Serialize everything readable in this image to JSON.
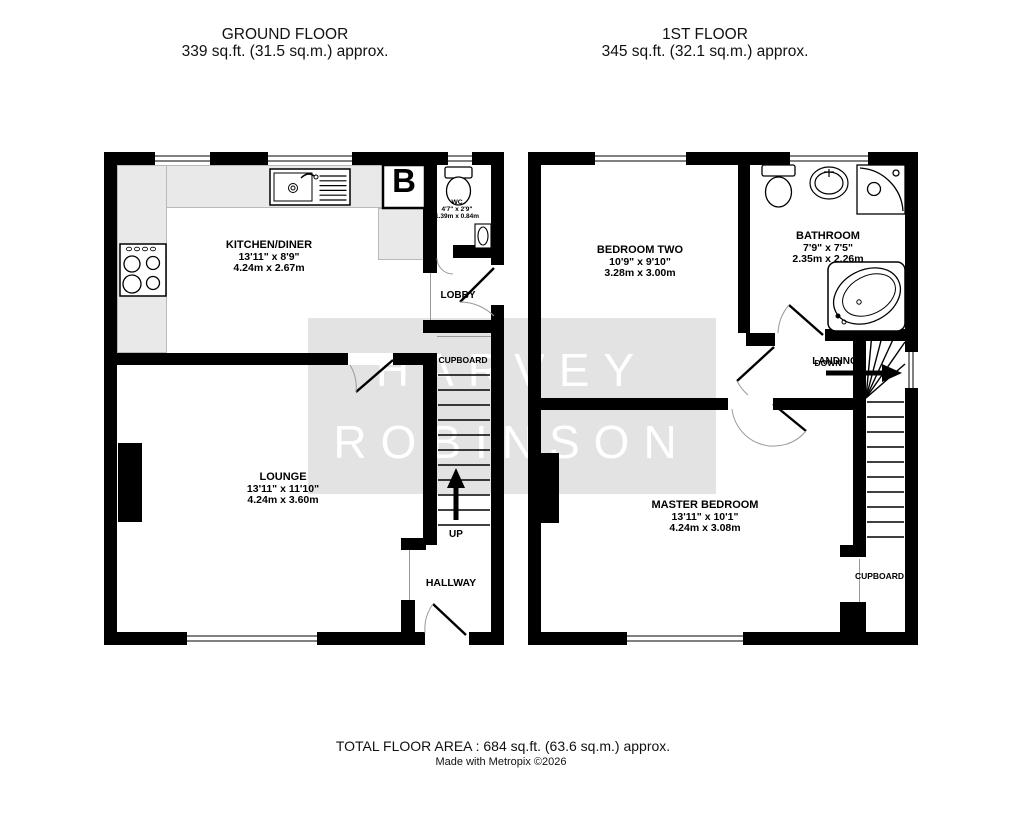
{
  "header": {
    "ground": {
      "title": "GROUND FLOOR",
      "area": "339 sq.ft. (31.5 sq.m.) approx."
    },
    "first": {
      "title": "1ST FLOOR",
      "area": "345 sq.ft. (32.1 sq.m.) approx."
    }
  },
  "ground_floor": {
    "kitchen": {
      "name": "KITCHEN/DINER",
      "imperial": "13'11\" x 8'9\"",
      "metric": "4.24m x 2.67m"
    },
    "wc": {
      "name": "WC",
      "imperial": "4'7\" x 2'9\"",
      "metric": "1.39m x 0.84m"
    },
    "lounge": {
      "name": "LOUNGE",
      "imperial": "13'11\" x 11'10\"",
      "metric": "4.24m x 3.60m"
    },
    "lobby": "LOBBY",
    "cupboard": "CUPBOARD",
    "hallway": "HALLWAY",
    "up": "UP",
    "boiler": "B"
  },
  "first_floor": {
    "bedroom_two": {
      "name": "BEDROOM TWO",
      "imperial": "10'9\" x 9'10\"",
      "metric": "3.28m x 3.00m"
    },
    "bathroom": {
      "name": "BATHROOM",
      "imperial": "7'9\" x 7'5\"",
      "metric": "2.35m x 2.26m"
    },
    "master": {
      "name": "MASTER BEDROOM",
      "imperial": "13'11\" x 10'1\"",
      "metric": "4.24m x 3.08m"
    },
    "landing": "LANDING",
    "down": "DOWN",
    "cupboard": "CUPBOARD"
  },
  "watermark": {
    "line1": "HARVEY",
    "line2": "ROBINSON"
  },
  "footer": {
    "total": "TOTAL FLOOR AREA : 684 sq.ft. (63.6 sq.m.) approx.",
    "credit": "Made with Metropix ©2026"
  },
  "colors": {
    "wall": "#000000",
    "watermark_bg": "#e3e3e3",
    "countertop": "#e9e9e9"
  }
}
